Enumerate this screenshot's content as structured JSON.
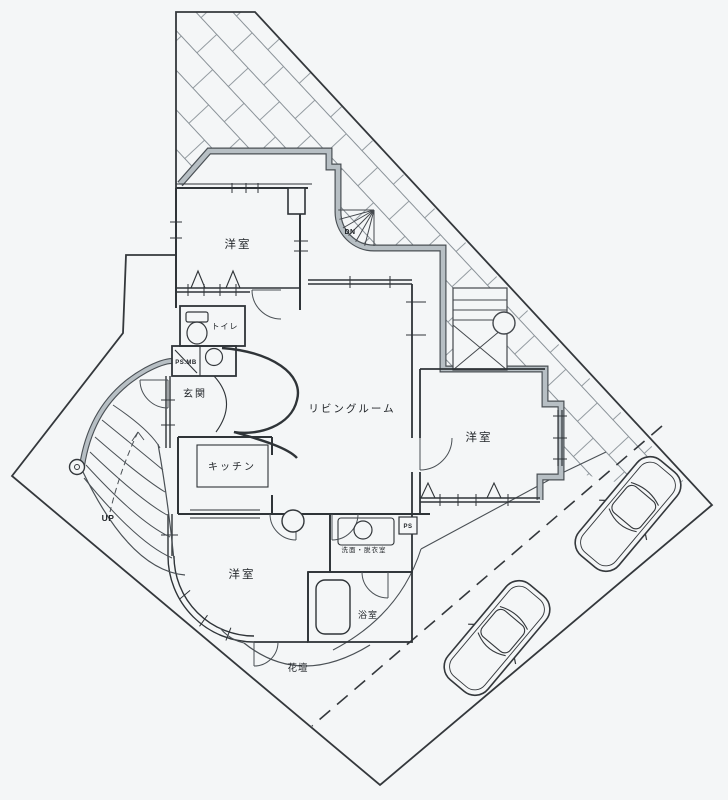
{
  "plan": {
    "rooms": {
      "western_room_top": "洋室",
      "western_room_right": "洋室",
      "western_room_bottom": "洋室",
      "living": "リビングルーム",
      "kitchen": "キッチン",
      "entrance": "玄関",
      "toilet": "トイレ",
      "washroom": "洗面・脱衣室",
      "bathroom": "浴室",
      "flower_bed": "花壇"
    },
    "annotations": {
      "up": "UP",
      "down": "DN",
      "ps": "PS",
      "ps_mb": "PS.MB"
    },
    "colors": {
      "paper": "#f4f6f7",
      "line": "#383d42",
      "wall_band": "#b7bfc4",
      "hatch": "#7d858c"
    },
    "objects": {
      "cars_parked": 2
    }
  }
}
